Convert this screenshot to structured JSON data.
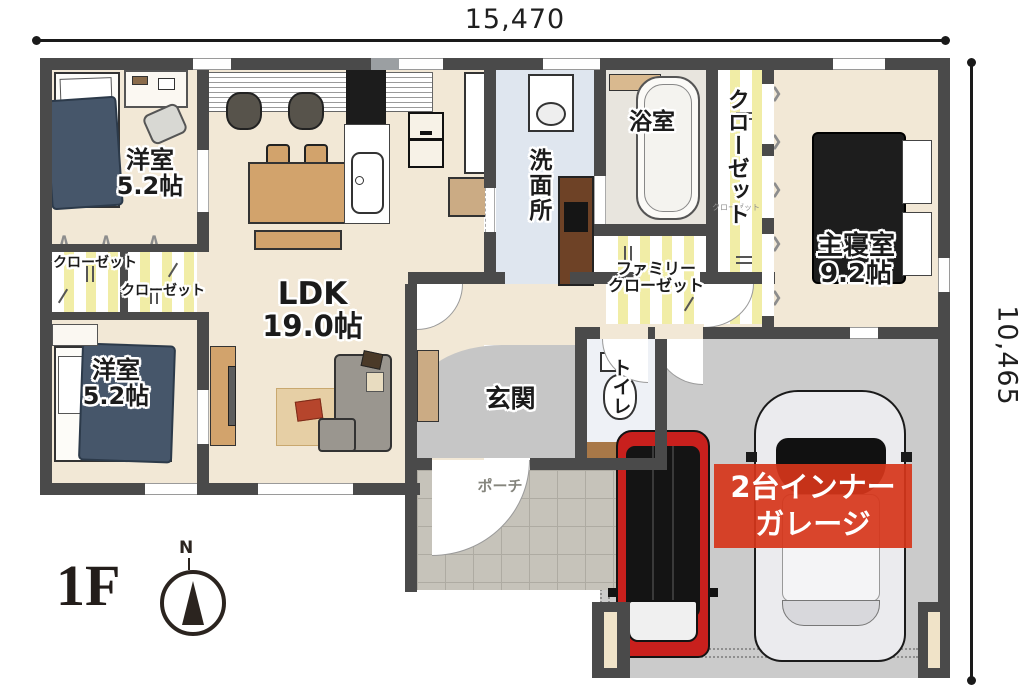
{
  "dimensions": {
    "top": "15,470",
    "right": "10,465"
  },
  "floor": {
    "label": "1F",
    "compass_north": "N"
  },
  "rooms": {
    "bedroom1": {
      "name": "洋室",
      "size": "5.2帖"
    },
    "bedroom2": {
      "name": "洋室",
      "size": "5.2帖"
    },
    "closet_a": {
      "name": "クローゼット"
    },
    "closet_b": {
      "name": "クローゼット"
    },
    "ldk": {
      "name": "LDK",
      "size": "19.0帖"
    },
    "washroom": {
      "name": "洗面所"
    },
    "bathroom": {
      "name": "浴室"
    },
    "family_closet": {
      "line1": "ファミリー",
      "line2": "クローゼット"
    },
    "walkin_closet": {
      "name": "クローゼット",
      "sub": "クローゼット"
    },
    "master_bedroom": {
      "name": "主寝室",
      "size": "9.2帖"
    },
    "entrance": {
      "name": "玄関"
    },
    "toilet": {
      "name": "トイレ"
    },
    "porch": {
      "name": "ポーチ"
    },
    "garage_banner": {
      "line1": "2台インナー",
      "line2": "ガレージ"
    }
  },
  "colors": {
    "wall": "#4a4a4a",
    "floor_cream": "#f2e8d6",
    "washroom_floor": "#dfe6ef",
    "bath_floor": "#e8e5de",
    "toilet_floor": "#eef1f6",
    "closet_stripe": "#f1eda6",
    "garage_floor": "#cbcbcb",
    "porch_tile": "#c6c3ba",
    "banner_red": "#d8391e",
    "bed_blue": "#46566a",
    "furniture_tan": "#d2a36c",
    "car_red": "#c8201d"
  }
}
